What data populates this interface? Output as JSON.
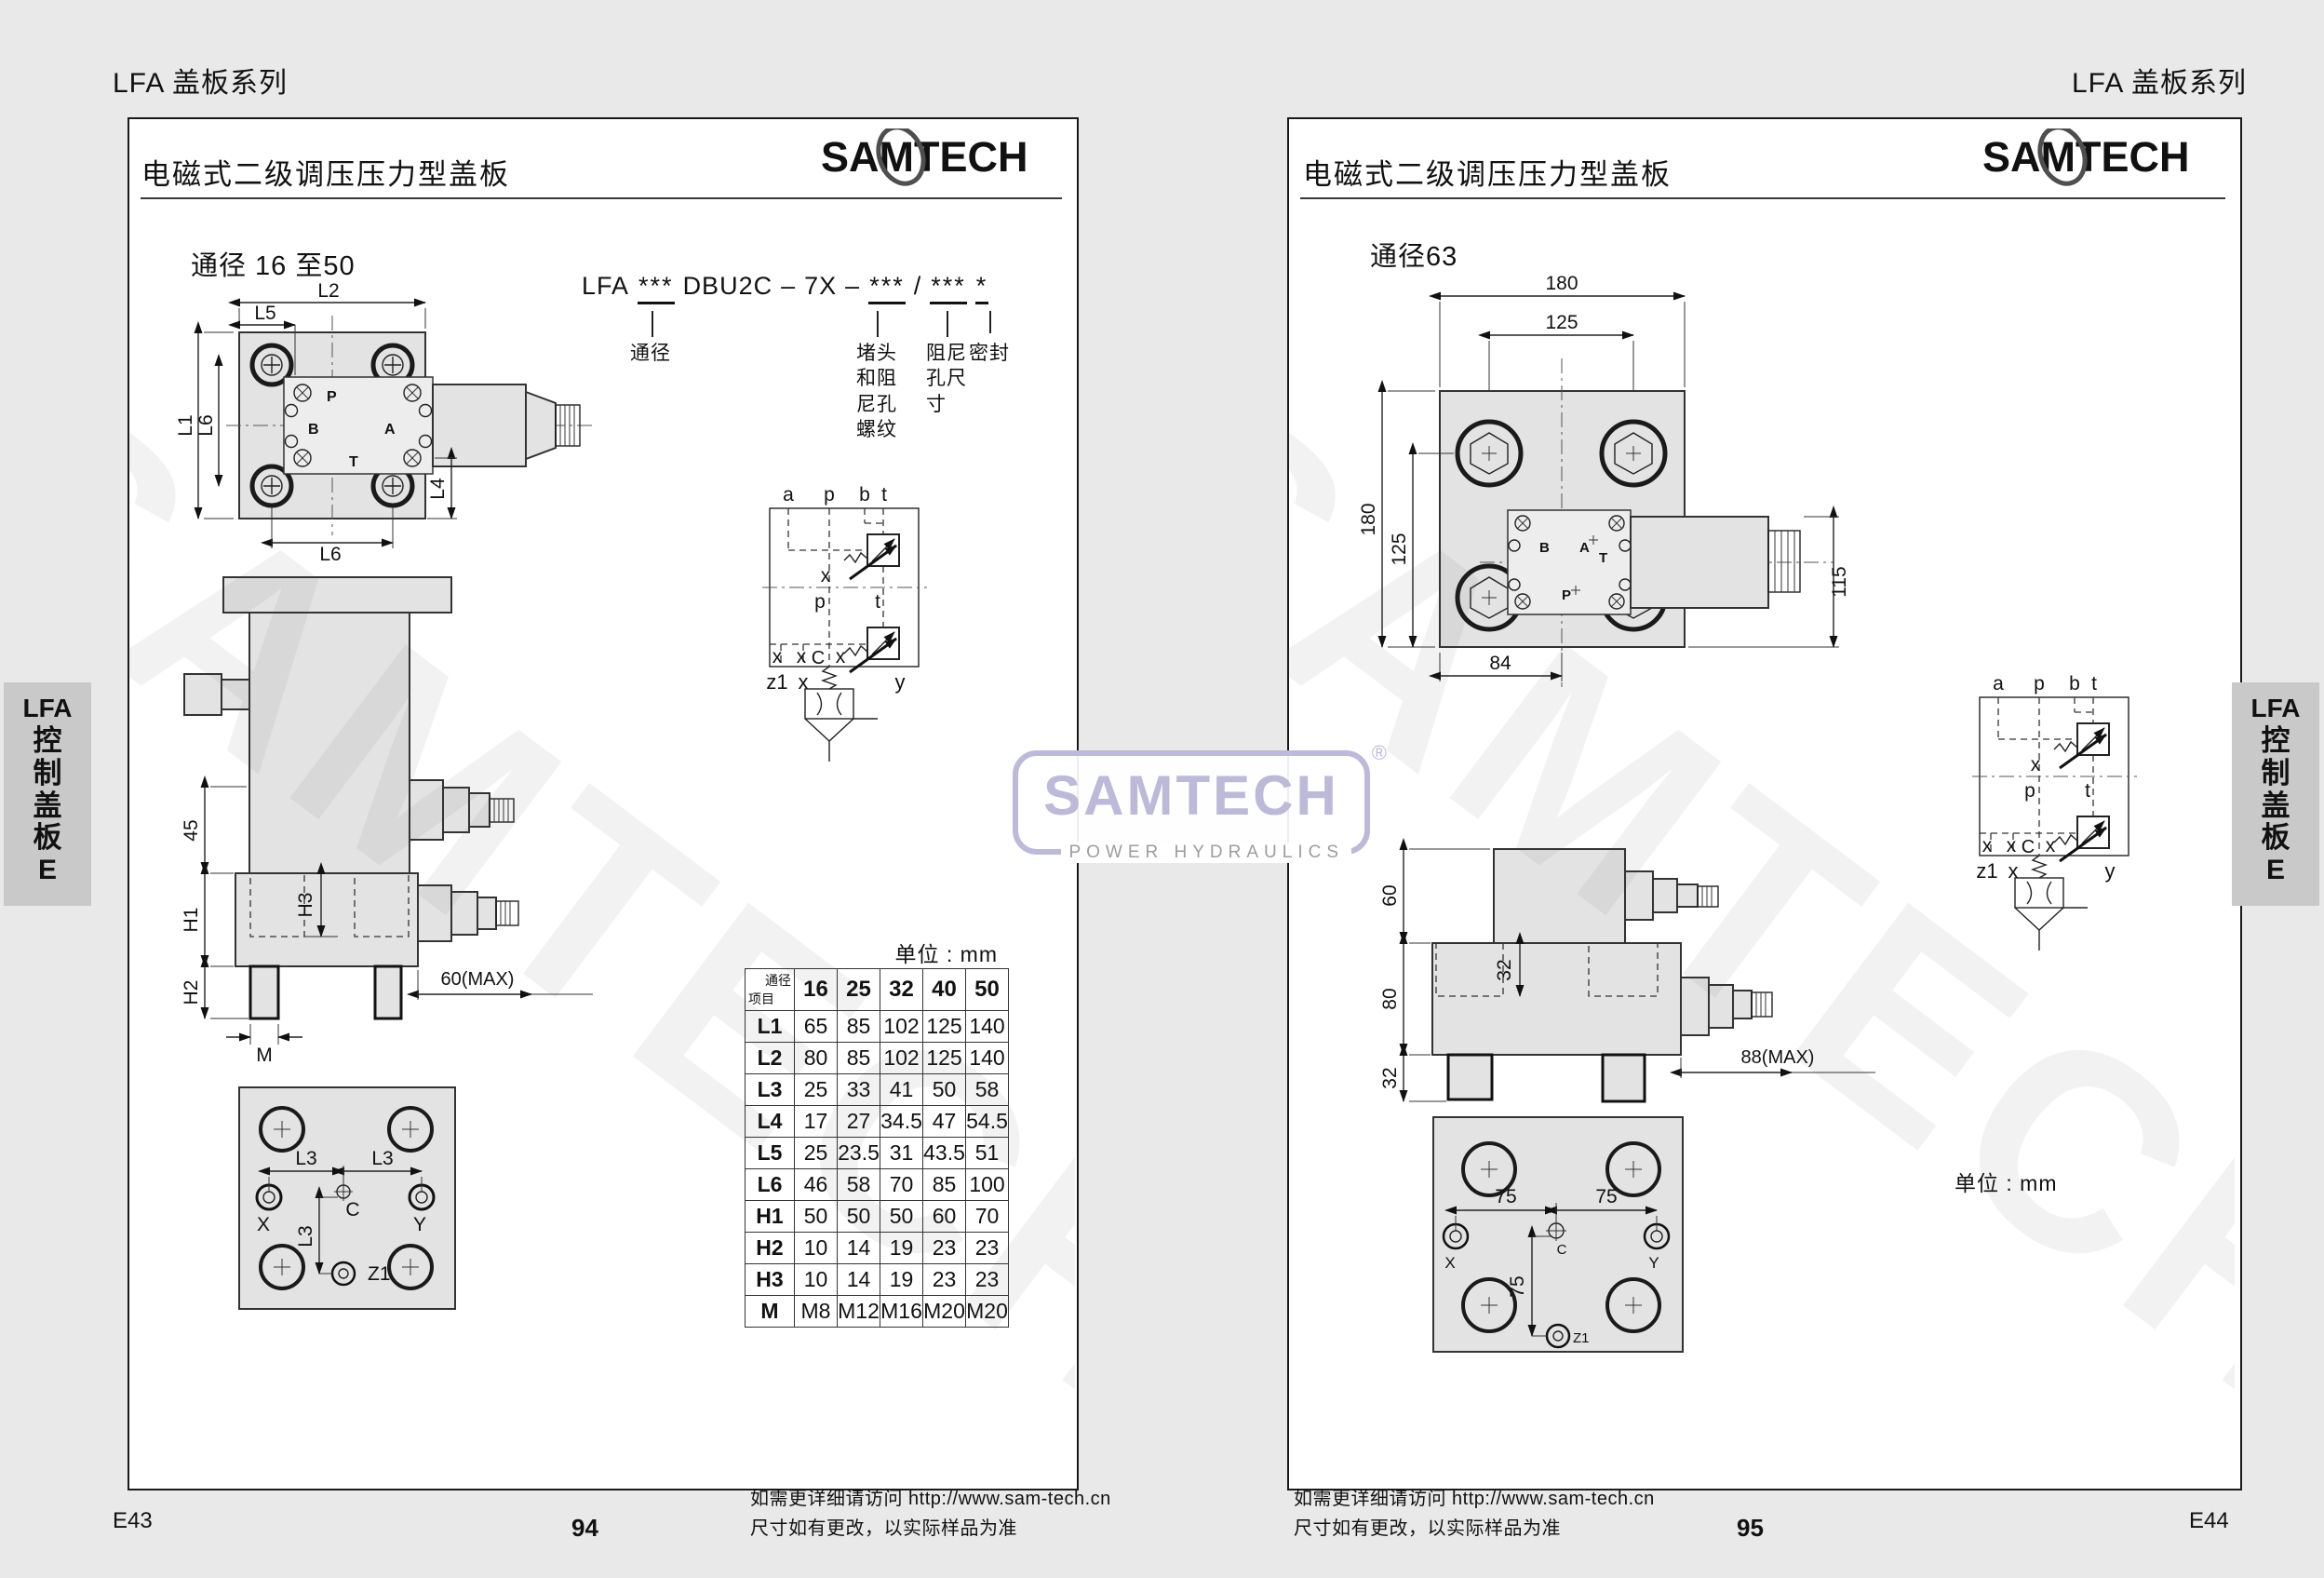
{
  "brand": {
    "name": "SAMTECH",
    "tagline": "POWER HYDRAULICS",
    "reg": "®"
  },
  "colors": {
    "brand_logo": "#4e4e4e",
    "watermark_logo": "#bcbad8",
    "tab_bg": "#c9c9c9",
    "drawing_fill": "#e3e3e3",
    "background": "#e9e9e9"
  },
  "header": {
    "series_left": "LFA 盖板系列",
    "series_right": "LFA 盖板系列"
  },
  "sidebar_tab": {
    "latin": "LFA",
    "chars": "控制盖板",
    "suffix": "E"
  },
  "schematic": {
    "a": "a",
    "p": "p",
    "b": "b",
    "t": "t",
    "x": "x",
    "p_mid": "p",
    "t_mid": "t",
    "c": "C",
    "z1": "z1",
    "y": "y"
  },
  "left_page": {
    "title": "电磁式二级调压压力型盖板",
    "size_heading": "通径 16 至50",
    "model_code": {
      "p1": "LFA",
      "p2": "***",
      "p3": "DBU2C",
      "d1": "–",
      "p4": "7X",
      "d2": "–",
      "p5": "***",
      "sl": "/",
      "p6": "***",
      "p7": "*",
      "label1": "通径",
      "label2": "堵头和阻尼孔螺纹",
      "label3": "阻尼孔尺寸",
      "label4": "密封"
    },
    "top_view": {
      "l2": "L2",
      "l5": "L5",
      "l1": "L1",
      "l6l": "L6",
      "l4": "L4",
      "l6b": "L6",
      "p": "P",
      "b": "B",
      "a": "A",
      "t": "T"
    },
    "side_view": {
      "d45": "45",
      "h3": "H3",
      "h1": "H1",
      "h2": "H2",
      "m": "M",
      "max": "60(MAX)"
    },
    "bottom_view": {
      "l3a": "L3",
      "l3b": "L3",
      "l3c": "L3",
      "x": "X",
      "c": "C",
      "y": "Y",
      "z1": "Z1"
    },
    "table": {
      "unit": "单位 : mm",
      "corner_top": "通径",
      "corner_bottom": "项目",
      "cols": [
        "16",
        "25",
        "32",
        "40",
        "50"
      ],
      "rows": [
        {
          "n": "L1",
          "v": [
            "65",
            "85",
            "102",
            "125",
            "140"
          ]
        },
        {
          "n": "L2",
          "v": [
            "80",
            "85",
            "102",
            "125",
            "140"
          ]
        },
        {
          "n": "L3",
          "v": [
            "25",
            "33",
            "41",
            "50",
            "58"
          ]
        },
        {
          "n": "L4",
          "v": [
            "17",
            "27",
            "34.5",
            "47",
            "54.5"
          ]
        },
        {
          "n": "L5",
          "v": [
            "25",
            "23.5",
            "31",
            "43.5",
            "51"
          ]
        },
        {
          "n": "L6",
          "v": [
            "46",
            "58",
            "70",
            "85",
            "100"
          ]
        },
        {
          "n": "H1",
          "v": [
            "50",
            "50",
            "50",
            "60",
            "70"
          ]
        },
        {
          "n": "H2",
          "v": [
            "10",
            "14",
            "19",
            "23",
            "23"
          ]
        },
        {
          "n": "H3",
          "v": [
            "10",
            "14",
            "19",
            "23",
            "23"
          ]
        },
        {
          "n": "M",
          "v": [
            "M8",
            "M12",
            "M16",
            "M20",
            "M20"
          ]
        }
      ]
    },
    "footer": {
      "code": "E43",
      "page": "94"
    }
  },
  "right_page": {
    "title": "电磁式二级调压压力型盖板",
    "size_heading": "通径63",
    "unit": "单位 : mm",
    "top_view": {
      "d180t": "180",
      "d125t": "125",
      "d180l": "180",
      "d125l": "125",
      "d115": "115",
      "d84": "84",
      "b": "B",
      "a": "A",
      "t": "T",
      "p": "P"
    },
    "side_view": {
      "d60": "60",
      "d80": "80",
      "d32l": "32",
      "d32i": "32",
      "max": "88(MAX)"
    },
    "bottom_view": {
      "d75a": "75",
      "d75b": "75",
      "d75c": "75",
      "x": "X",
      "c": "C",
      "y": "Y",
      "z1": "Z1"
    },
    "footer": {
      "code": "E44",
      "page": "95"
    }
  },
  "footer_note": {
    "line1": "如需更详细请访问 http://www.sam-tech.cn",
    "line2": "尺寸如有更改，以实际样品为准"
  }
}
